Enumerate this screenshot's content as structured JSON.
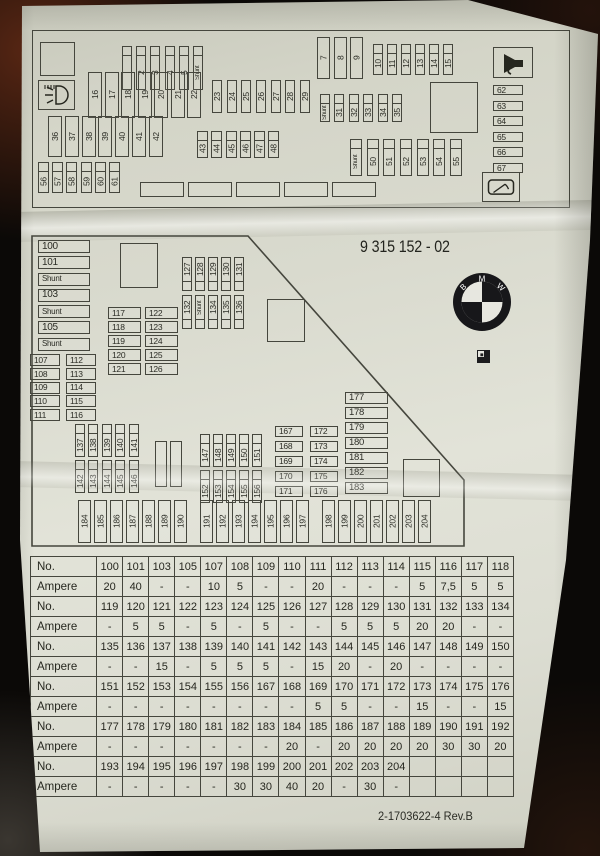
{
  "top_panel": {
    "row_1_5": [
      "",
      "2",
      "3",
      "4",
      "5",
      "Shunt"
    ],
    "row_16_22": [
      "16",
      "17",
      "18",
      "19",
      "20",
      "21",
      "22"
    ],
    "row_23_29": [
      "23",
      "24",
      "25",
      "26",
      "27",
      "28",
      "29"
    ],
    "row_7_9": [
      "7",
      "8",
      "9"
    ],
    "row_10_15": [
      "10",
      "11",
      "12",
      "13",
      "14",
      "15"
    ],
    "row_31_35": [
      "Shunt",
      "31",
      "32",
      "33",
      "34",
      "35"
    ],
    "row_36_42": [
      "36",
      "37",
      "38",
      "39",
      "40",
      "41",
      "42"
    ],
    "row_43_48": [
      "43",
      "44",
      "45",
      "46",
      "47",
      "48"
    ],
    "row_50_55": [
      "Shunt",
      "50",
      "51",
      "52",
      "53",
      "54",
      "55"
    ],
    "row_56_61": [
      "56",
      "57",
      "58",
      "59",
      "60",
      "61"
    ],
    "col_62_67": [
      "62",
      "63",
      "64",
      "65",
      "66",
      "67"
    ],
    "blank_row": [
      "",
      "",
      "",
      "",
      ""
    ]
  },
  "middle_panel": {
    "part_number": "9 315 152 - 02",
    "logo_letters": [
      "B",
      "M",
      "W"
    ],
    "col_100_shunt": [
      "100",
      "101",
      "Shunt",
      "103",
      "Shunt",
      "105",
      "Shunt"
    ],
    "col_107_111": [
      "107",
      "108",
      "109",
      "110",
      "111"
    ],
    "col_112_116": [
      "112",
      "113",
      "114",
      "115",
      "116"
    ],
    "col_117_121": [
      "117",
      "118",
      "119",
      "120",
      "121"
    ],
    "col_122_126": [
      "122",
      "123",
      "124",
      "125",
      "126"
    ],
    "row_127_131": [
      "127",
      "128",
      "129",
      "130",
      "131"
    ],
    "row_132_136": [
      "132",
      "Shunt",
      "134",
      "135",
      "136"
    ],
    "row_137_141": [
      "137",
      "138",
      "139",
      "140",
      "141"
    ],
    "row_142_146": [
      "142",
      "143",
      "144",
      "145",
      "146"
    ],
    "row_147_151": [
      "147",
      "148",
      "149",
      "150",
      "151"
    ],
    "row_152_156": [
      "152",
      "153",
      "154",
      "155",
      "156"
    ],
    "col_167_171": [
      "167",
      "168",
      "169",
      "170",
      "171"
    ],
    "col_172_176": [
      "172",
      "173",
      "174",
      "175",
      "176"
    ],
    "col_177_183": [
      "177",
      "178",
      "179",
      "180",
      "181",
      "182",
      "183"
    ],
    "row_184_190": [
      "184",
      "185",
      "186",
      "187",
      "188",
      "189",
      "190"
    ],
    "row_191_197": [
      "191",
      "192",
      "193",
      "194",
      "195",
      "196",
      "197"
    ],
    "row_198_204": [
      "198",
      "199",
      "200",
      "201",
      "202",
      "203",
      "204"
    ],
    "blank_pair": [
      "",
      ""
    ]
  },
  "icons": {
    "headlight_washer": "headlight-washer-icon",
    "horn": "horn-icon",
    "rear_wiper": "rear-wiper-icon",
    "logo": "bmw-roundel",
    "print_mark": "print-registration-mark"
  },
  "table": {
    "no_label": "No.",
    "ampere_label": "Ampere",
    "groups": [
      {
        "nos": [
          "100",
          "101",
          "103",
          "105",
          "107",
          "108",
          "109",
          "110",
          "111",
          "112",
          "113",
          "114",
          "115",
          "116",
          "117",
          "118"
        ],
        "amps": [
          "20",
          "40",
          "-",
          "-",
          "10",
          "5",
          "-",
          "-",
          "20",
          "-",
          "-",
          "-",
          "5",
          "7,5",
          "5",
          "5"
        ]
      },
      {
        "nos": [
          "119",
          "120",
          "121",
          "122",
          "123",
          "124",
          "125",
          "126",
          "127",
          "128",
          "129",
          "130",
          "131",
          "132",
          "133",
          "134"
        ],
        "amps": [
          "-",
          "5",
          "5",
          "-",
          "5",
          "-",
          "5",
          "-",
          "-",
          "5",
          "5",
          "5",
          "20",
          "20",
          "-",
          "-"
        ]
      },
      {
        "nos": [
          "135",
          "136",
          "137",
          "138",
          "139",
          "140",
          "141",
          "142",
          "143",
          "144",
          "145",
          "146",
          "147",
          "148",
          "149",
          "150"
        ],
        "amps": [
          "-",
          "-",
          "15",
          "-",
          "5",
          "5",
          "5",
          "-",
          "15",
          "20",
          "-",
          "20",
          "-",
          "-",
          "-",
          "-"
        ]
      },
      {
        "nos": [
          "151",
          "152",
          "153",
          "154",
          "155",
          "156",
          "167",
          "168",
          "169",
          "170",
          "171",
          "172",
          "173",
          "174",
          "175",
          "176"
        ],
        "amps": [
          "-",
          "-",
          "-",
          "-",
          "-",
          "-",
          "-",
          "-",
          "5",
          "5",
          "-",
          "-",
          "15",
          "-",
          "-",
          "15"
        ]
      },
      {
        "nos": [
          "177",
          "178",
          "179",
          "180",
          "181",
          "182",
          "183",
          "184",
          "185",
          "186",
          "187",
          "188",
          "189",
          "190",
          "191",
          "192"
        ],
        "amps": [
          "-",
          "-",
          "-",
          "-",
          "-",
          "-",
          "-",
          "20",
          "-",
          "20",
          "20",
          "20",
          "20",
          "30",
          "30",
          "20"
        ]
      },
      {
        "nos": [
          "193",
          "194",
          "195",
          "196",
          "197",
          "198",
          "199",
          "200",
          "201",
          "202",
          "203",
          "204",
          "",
          "",
          "",
          ""
        ],
        "amps": [
          "-",
          "-",
          "-",
          "-",
          "-",
          "30",
          "30",
          "40",
          "20",
          "-",
          "30",
          "-",
          "",
          "",
          "",
          ""
        ]
      }
    ]
  },
  "footer": {
    "doc_number": "2-1703622-4 Rev.B"
  }
}
